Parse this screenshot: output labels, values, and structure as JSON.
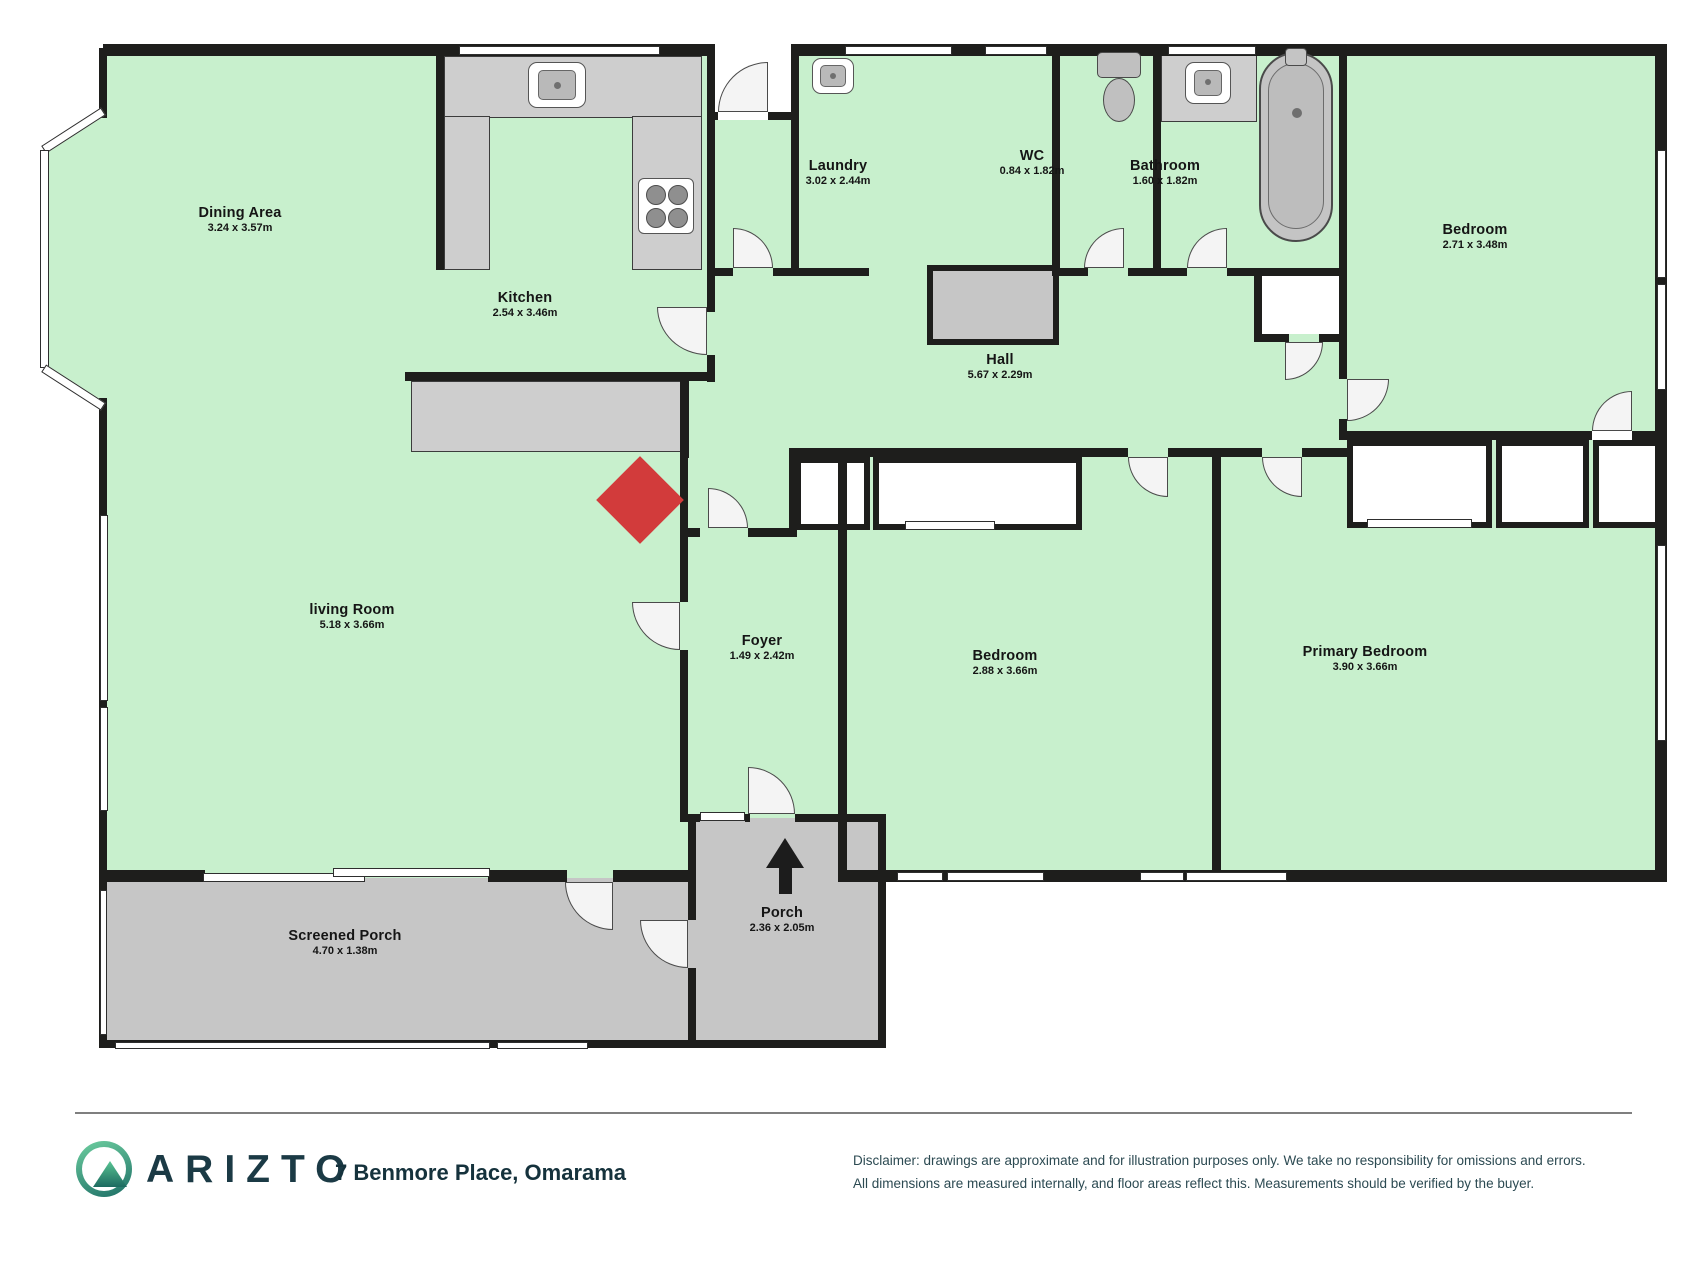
{
  "page": {
    "type": "floor-plan"
  },
  "rooms": [
    {
      "name": "Dining Area",
      "dims": "3.24 x 3.57m"
    },
    {
      "name": "Kitchen",
      "dims": "2.54 x 3.46m"
    },
    {
      "name": "Laundry",
      "dims": "3.02 x 2.44m"
    },
    {
      "name": "WC",
      "dims": "0.84 x 1.82m"
    },
    {
      "name": "Bathroom",
      "dims": "1.60 x 1.82m"
    },
    {
      "name": "Bedroom",
      "dims": "2.71 x 3.48m"
    },
    {
      "name": "Hall",
      "dims": "5.67 x 2.29m"
    },
    {
      "name": "living Room",
      "dims": "5.18 x 3.66m"
    },
    {
      "name": "Foyer",
      "dims": "1.49 x 2.42m"
    },
    {
      "name": "Bedroom",
      "dims": "2.88 x 3.66m"
    },
    {
      "name": "Primary Bedroom",
      "dims": "3.90 x 3.66m"
    },
    {
      "name": "Screened Porch",
      "dims": "4.70 x 1.38m"
    },
    {
      "name": "Porch",
      "dims": "2.36 x 2.05m"
    }
  ],
  "fixtures": [
    "kitchen-sink",
    "stove",
    "laundry-sink",
    "toilet",
    "bathroom-sink",
    "bathtub",
    "entrance-arrow",
    "fireplace-marker"
  ],
  "footer": {
    "brand": "ARIZTO",
    "address": "7 Benmore Place, Omarama",
    "disclaimer_line1": "Disclaimer: drawings are approximate and for illustration purposes only. We take no responsibility for omissions and errors.",
    "disclaimer_line2": "All dimensions are measured internally, and floor areas reflect this. Measurements should be verified by the buyer."
  },
  "colors": {
    "room_fill": "#c8f0cd",
    "wall": "#1e1e1c",
    "porch_fill": "#c6c6c6",
    "accent_red": "#d23b3b",
    "brand_teal": "#1b3a45"
  }
}
